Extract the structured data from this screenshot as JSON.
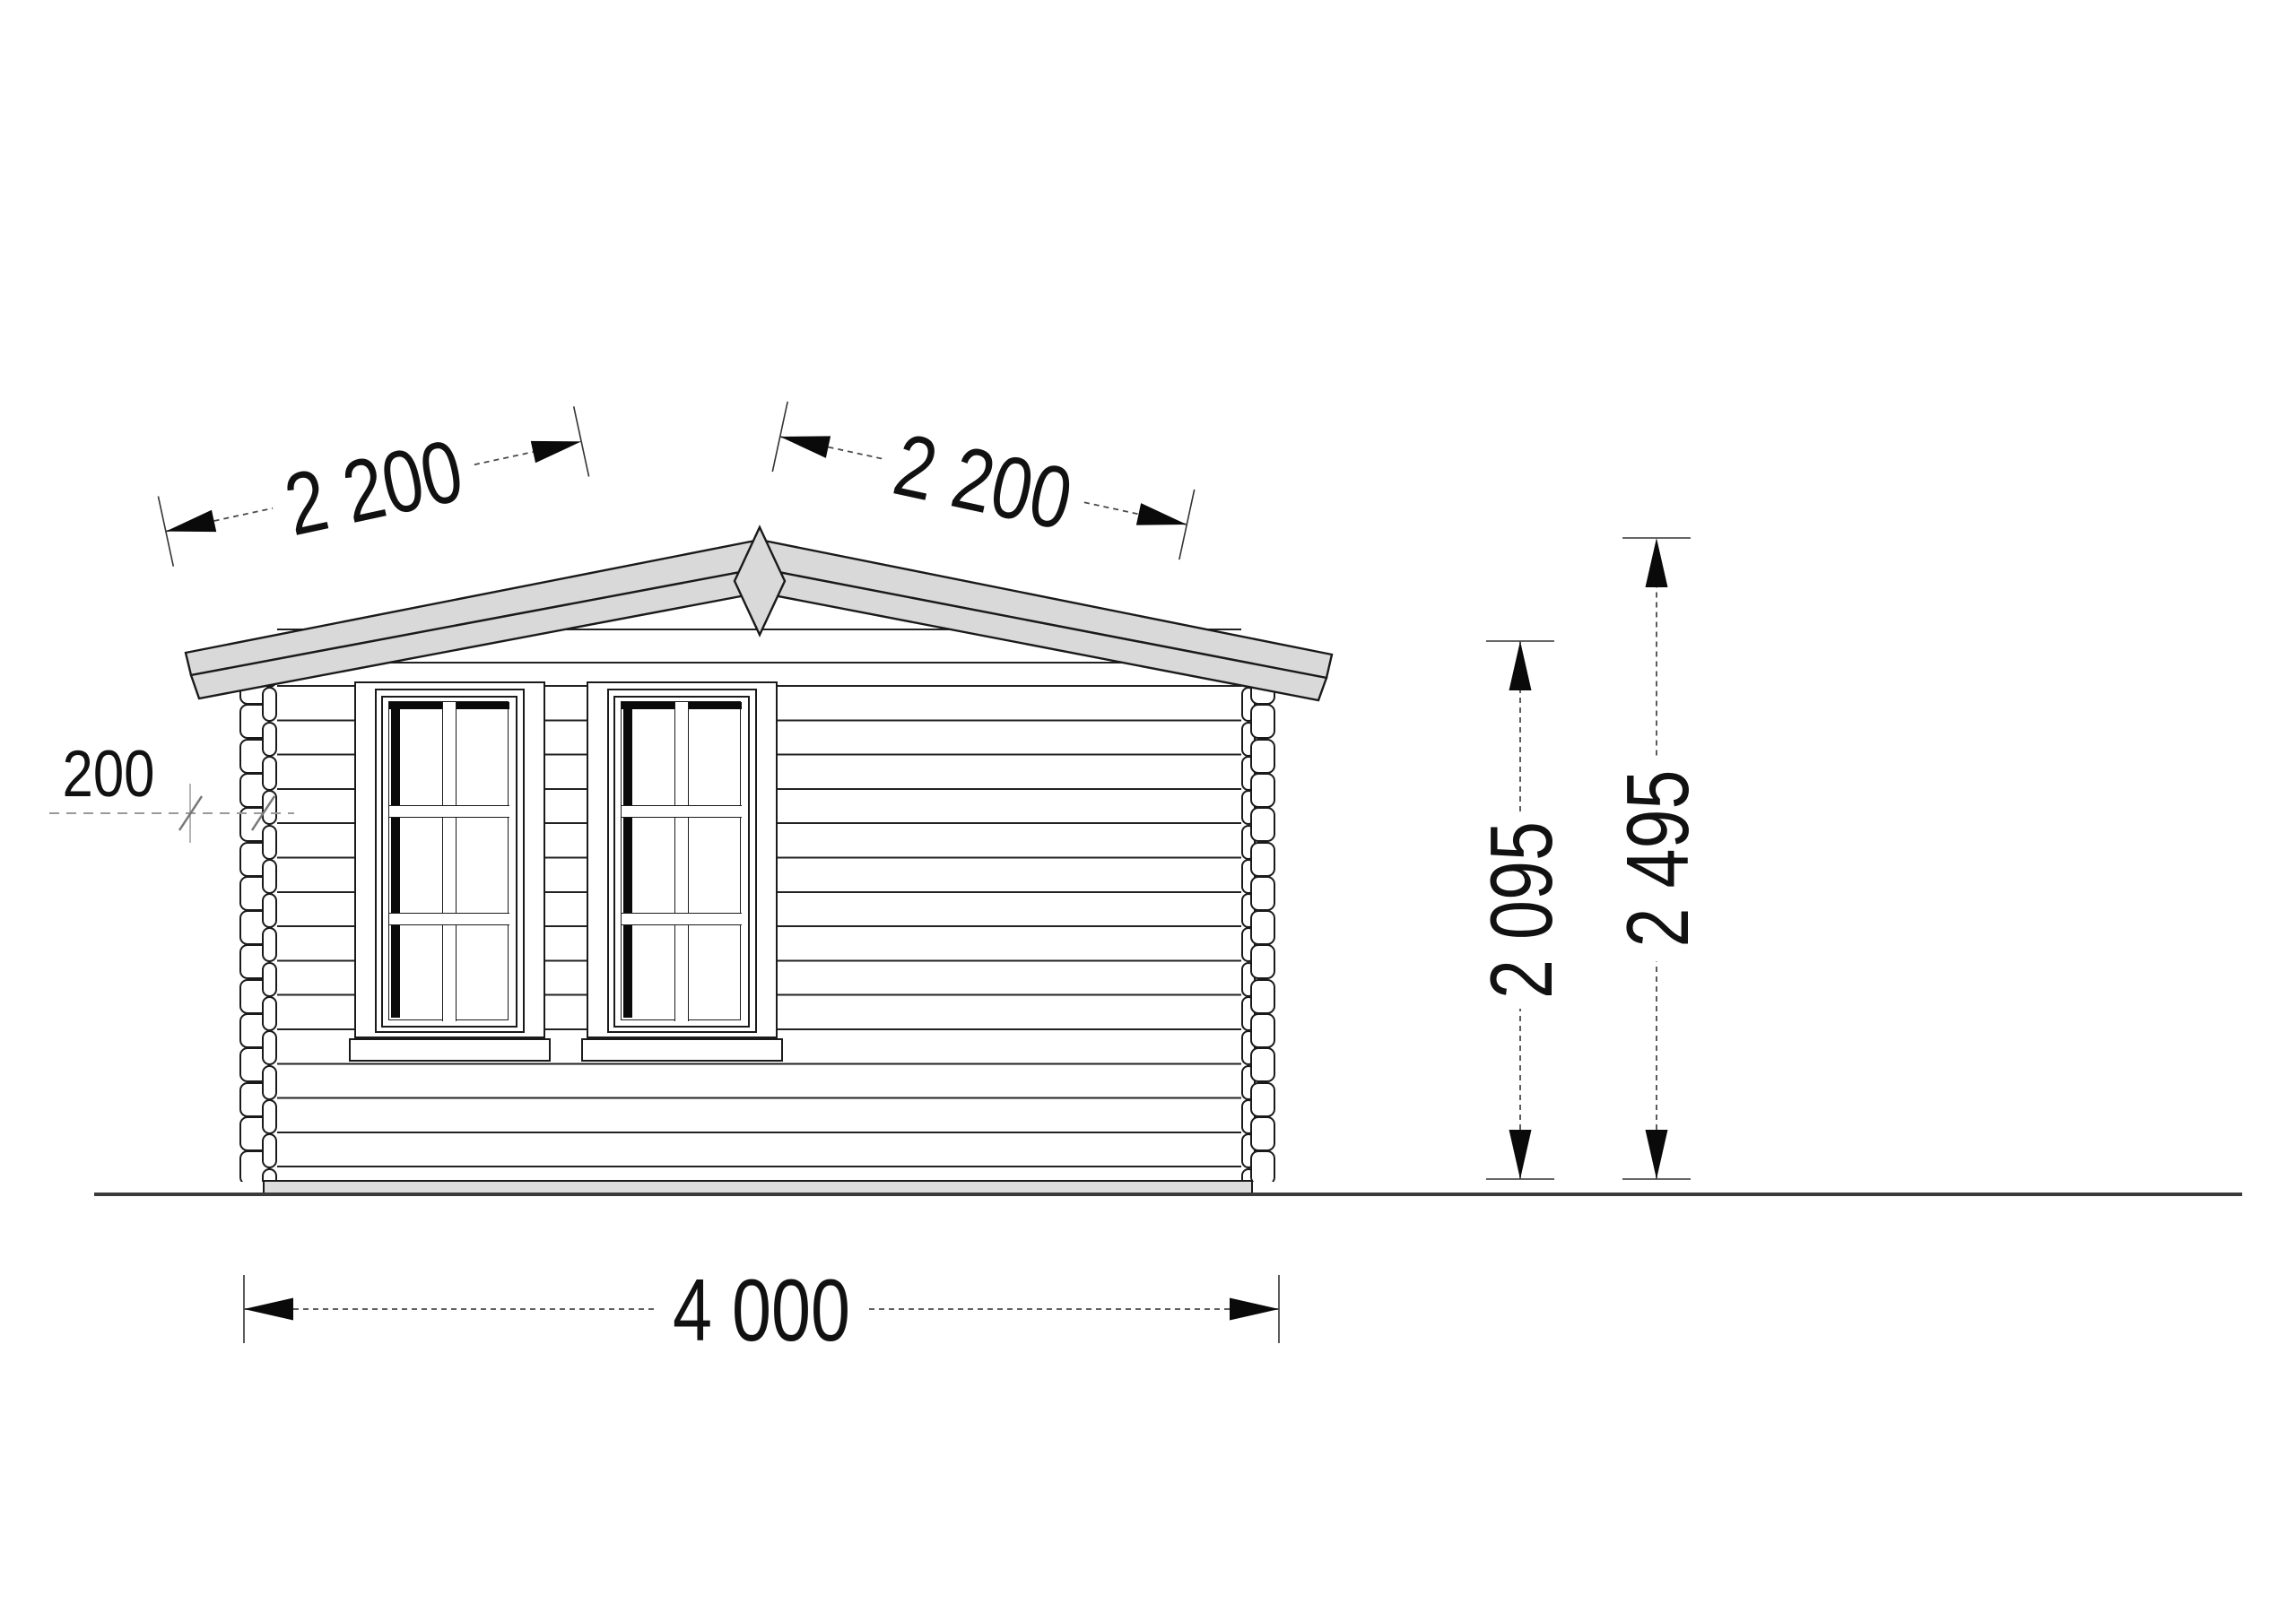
{
  "title": "Log cabin gable elevation drawing",
  "dimensions": {
    "roof_slope_left": "2 200",
    "roof_slope_right": "2 200",
    "roof_overhang": "200",
    "wall_height": "2 095",
    "ridge_height": "2 495",
    "building_width": "4 000"
  },
  "colors": {
    "roof_fill": "#d9d9d9",
    "foundation_fill": "#dcdcdc",
    "line": "#1a1a1a",
    "dimension_line": "#4a4a4a",
    "construction_gray": "#9a9a9a",
    "text": "#111111",
    "background": "#ffffff"
  }
}
